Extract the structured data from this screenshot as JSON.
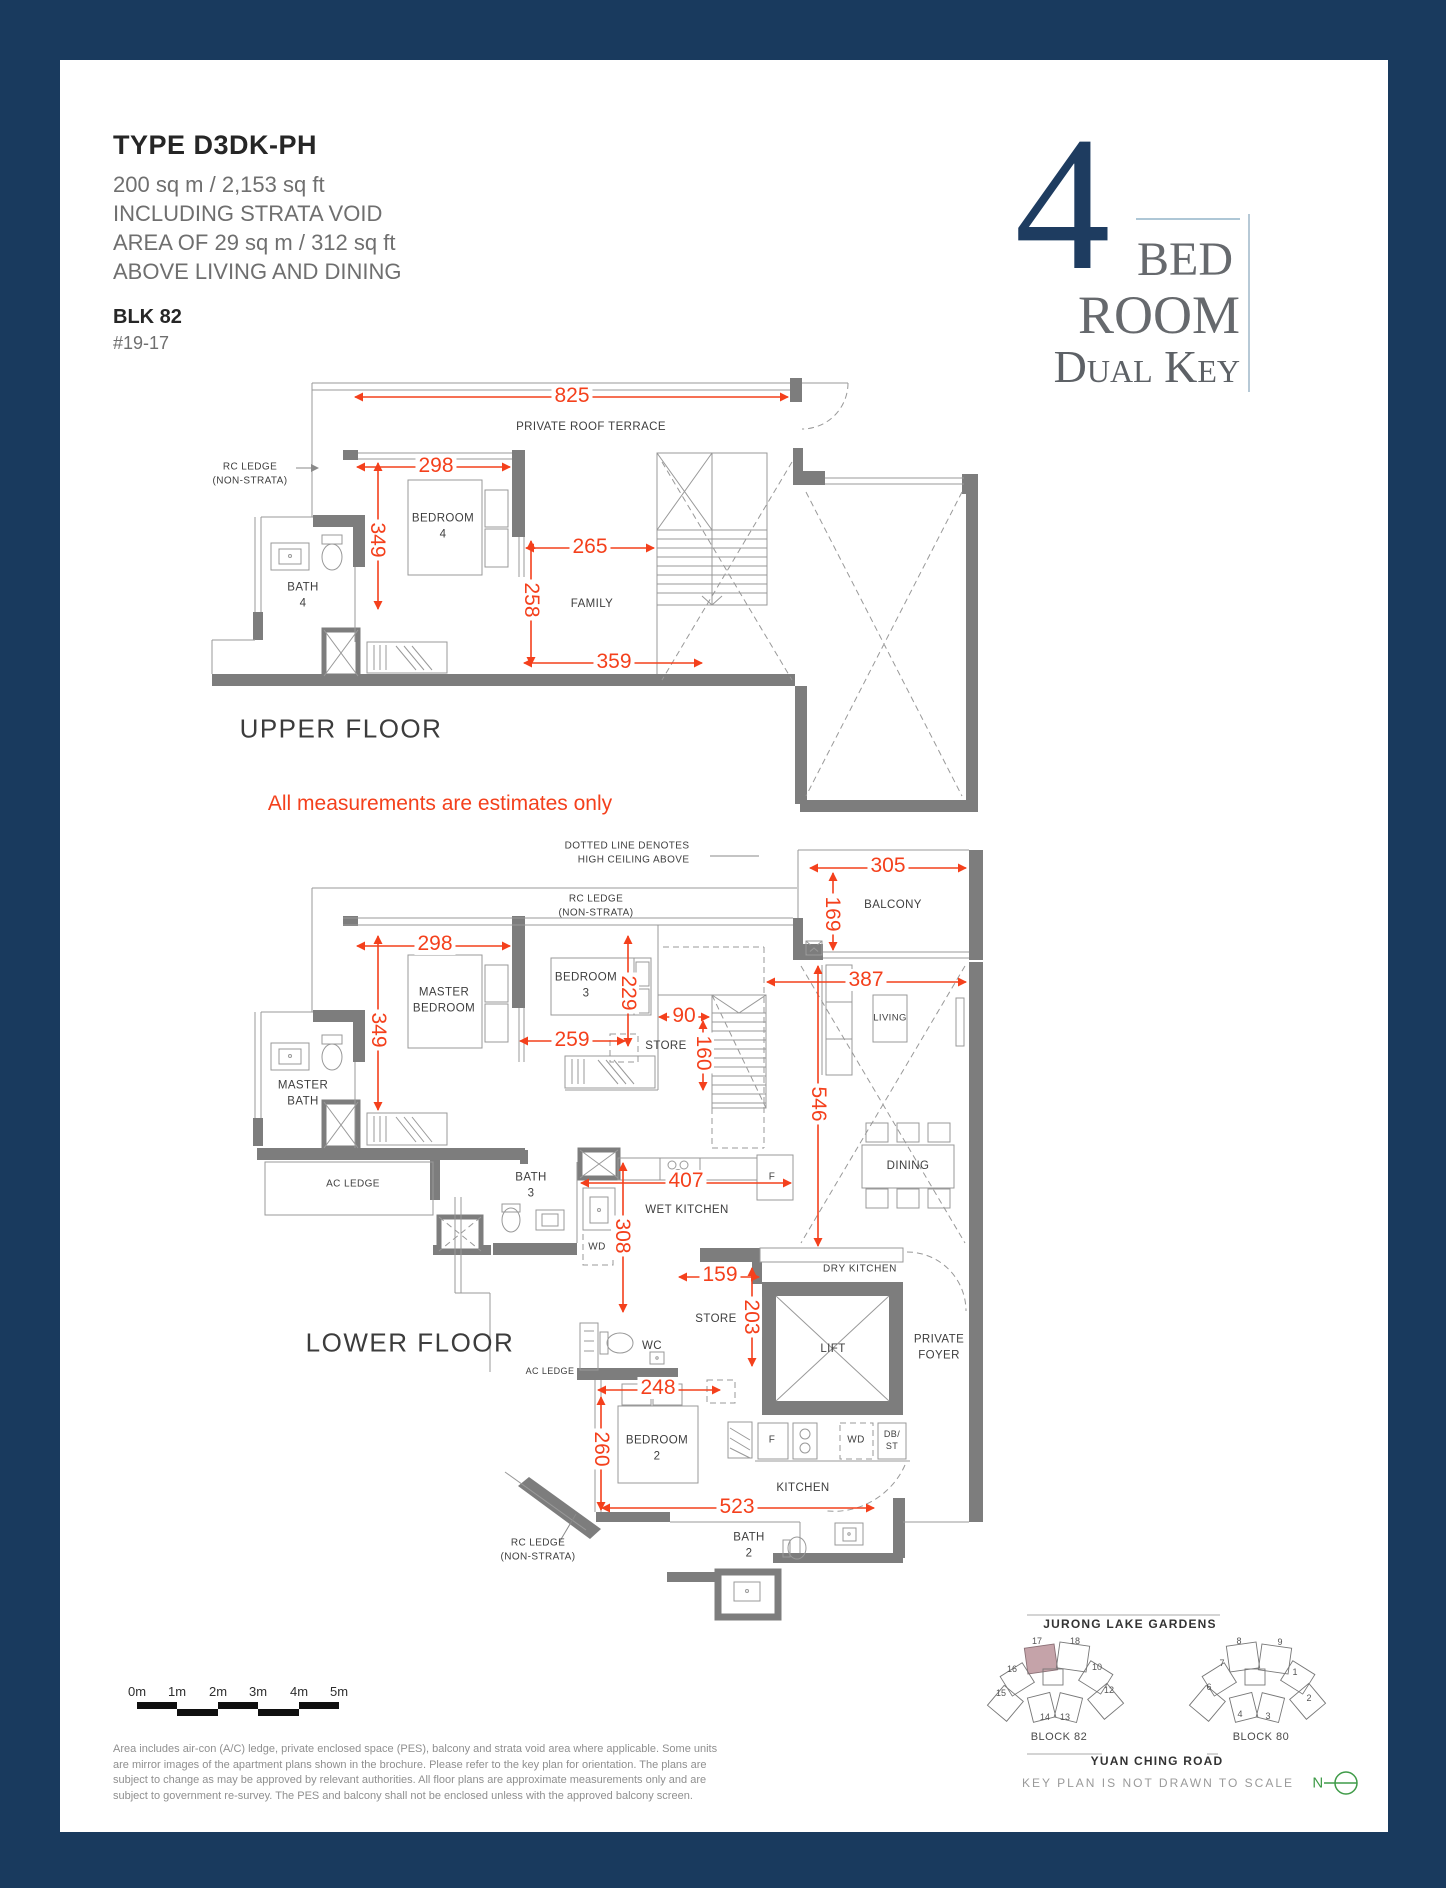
{
  "header": {
    "title": "TYPE D3DK-PH",
    "area_lines": "200 sq m / 2,153 sq ft\nINCLUDING STRATA VOID\nAREA OF 29 sq m / 312 sq ft\nABOVE LIVING AND DINING",
    "block": "BLK 82",
    "unit": "#19-17"
  },
  "logo": {
    "number": "4",
    "bed": "BED",
    "room": "ROOM",
    "dual_key": "Dual Key"
  },
  "note": "All measurements are estimates only",
  "upper_floor": {
    "title": "UPPER FLOOR",
    "labels": {
      "terrace": "PRIVATE ROOF TERRACE",
      "rc_ledge": "RC LEDGE\n(NON-STRATA)",
      "bedroom4": "BEDROOM\n4",
      "bath4": "BATH\n4",
      "family": "FAMILY"
    },
    "dims": {
      "w825": "825",
      "w298": "298",
      "h349": "349",
      "w265": "265",
      "h258": "258",
      "w359": "359"
    }
  },
  "lower_floor": {
    "title": "LOWER FLOOR",
    "high_ceiling_note": "DOTTED LINE DENOTES\nHIGH CEILING ABOVE",
    "labels": {
      "rc_ledge_top": "RC LEDGE\n(NON-STRATA)",
      "balcony": "BALCONY",
      "master_bedroom": "MASTER\nBEDROOM",
      "bedroom3": "BEDROOM\n3",
      "master_bath": "MASTER\nBATH",
      "living": "LIVING",
      "dining": "DINING",
      "store": "STORE",
      "wet_kitchen": "WET KITCHEN",
      "dry_kitchen": "DRY KITCHEN",
      "kitchen": "KITCHEN",
      "bath3": "BATH\n3",
      "bath2": "BATH\n2",
      "wc": "WC",
      "wd": "WD",
      "fridge": "F",
      "db_st": "DB/\nST",
      "ac_ledge": "AC LEDGE",
      "lift": "LIFT",
      "private_foyer": "PRIVATE\nFOYER",
      "bedroom2": "BEDROOM\n2",
      "rc_ledge_bottom": "RC LEDGE\n(NON-STRATA)"
    },
    "dims": {
      "w305": "305",
      "h169": "169",
      "w298": "298",
      "h349": "349",
      "h229": "229",
      "w259": "259",
      "w90": "90",
      "h160": "160",
      "w387": "387",
      "h546": "546",
      "w407": "407",
      "h308": "308",
      "w159": "159",
      "h203": "203",
      "w248": "248",
      "h260": "260",
      "w523": "523"
    }
  },
  "scale_bar": {
    "labels": [
      "0m",
      "1m",
      "2m",
      "3m",
      "4m",
      "5m"
    ]
  },
  "disclaimer": "Area includes air-con (A/C) ledge, private enclosed space (PES), balcony and strata void area where applicable. Some units are mirror images of the apartment plans shown in the brochure. Please refer to the key plan for orientation. The plans are subject to change as may be approved by relevant authorities. All floor plans are approximate measurements only and are subject to government re-survey. The PES and balcony shall not be enclosed unless with the approved balcony screen.",
  "key_plan": {
    "top_road": "JURONG LAKE GARDENS",
    "bottom_road": "YUAN CHING ROAD",
    "note": "KEY PLAN IS NOT DRAWN TO SCALE",
    "block82": "BLOCK 82",
    "block80": "BLOCK 80",
    "compass": "N",
    "block82_units": [
      "17",
      "18",
      "16",
      "10",
      "15",
      "12",
      "14",
      "13"
    ],
    "block80_units": [
      "8",
      "9",
      "7",
      "1",
      "6",
      "2",
      "4",
      "3"
    ]
  },
  "colors": {
    "frame": "#193a5e",
    "dimension": "#f4401c",
    "wall": "#7d7d7d",
    "logo_navy": "#1e3c60",
    "highlight_unit": "#c5a3a9",
    "compass_green": "#3f9b48"
  }
}
